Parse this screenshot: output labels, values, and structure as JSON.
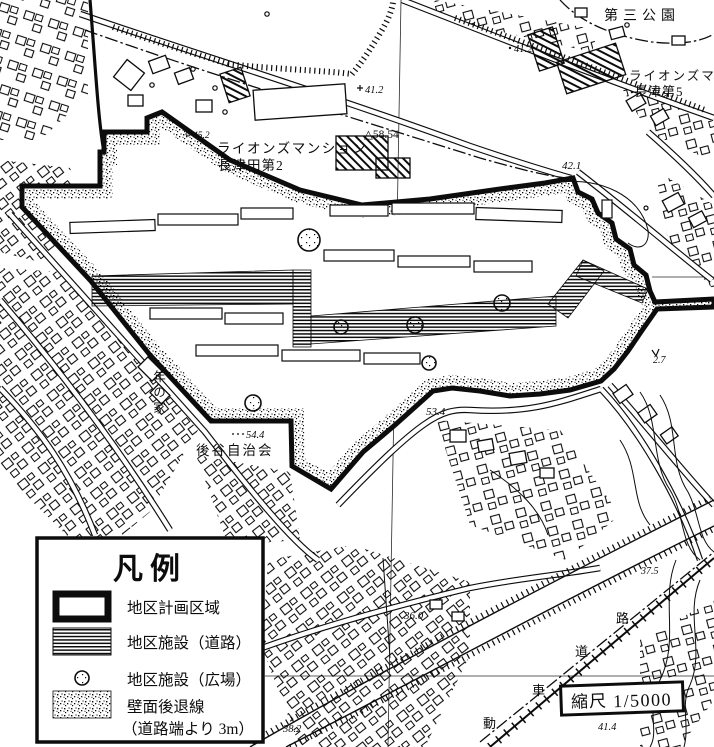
{
  "map_labels": {
    "park": "第三公園",
    "mansion5_line1": "ライオンズマ",
    "mansion5_line2": "長津第5",
    "mansion2_line1": "ライオンズマンション",
    "mansion2_line2": "長津田第2",
    "youth_home": "年の家",
    "assoc": "後谷自治会",
    "road_chars": [
      "動",
      "車",
      "道",
      "路"
    ]
  },
  "elevations": {
    "top_left": "41.2",
    "top_mid": "41.2",
    "corner": "42.1",
    "bench": "45.2",
    "triangulation": "△58.54",
    "south1": "53.4",
    "assoc_spot": "54.4",
    "south2": "36.0",
    "southeast": "37.5",
    "bottom_left": "38.2",
    "bottom_right": "41.4",
    "spot27": "2.7"
  },
  "legend": {
    "title": "凡例",
    "items": [
      {
        "label": "地区計画区域"
      },
      {
        "label": "地区施設（道路）"
      },
      {
        "label": "地区施設（広場）"
      },
      {
        "label": "壁面後退線",
        "label2": "（道路端より 3m）"
      }
    ]
  },
  "scale": {
    "label": "縮尺",
    "value": "1/5000"
  }
}
